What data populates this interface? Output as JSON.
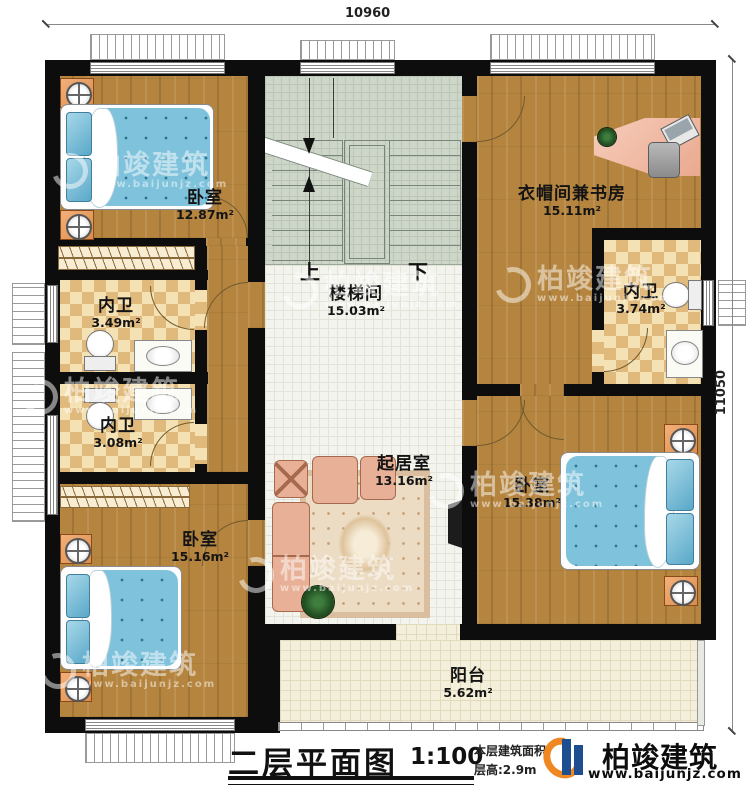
{
  "dimensions": {
    "top": "10960",
    "right": "11050"
  },
  "stairs": {
    "up": "上",
    "down": "下"
  },
  "rooms": [
    {
      "id": "bedroom-top-left",
      "name": "卧室",
      "area": "12.87m²"
    },
    {
      "id": "cloakroom-study",
      "name": "衣帽间兼书房",
      "area": "15.11m²"
    },
    {
      "id": "bath-left-upper",
      "name": "内卫",
      "area": "3.49m²"
    },
    {
      "id": "bath-right",
      "name": "内卫",
      "area": "3.74m²"
    },
    {
      "id": "bath-left-lower",
      "name": "内卫",
      "area": "3.08m²"
    },
    {
      "id": "stair-hall",
      "name": "楼梯间",
      "area": "15.03m²"
    },
    {
      "id": "living",
      "name": "起居室",
      "area": "13.16m²"
    },
    {
      "id": "bedroom-right",
      "name": "卧室",
      "area": "15.38m²"
    },
    {
      "id": "bedroom-bottom-left",
      "name": "卧室",
      "area": "15.16m²"
    },
    {
      "id": "balcony",
      "name": "阳台",
      "area": "5.62m²"
    }
  ],
  "title_block": {
    "title": "二层平面图",
    "scale": "1:100",
    "area_line": "本层建筑面积:",
    "height_line": "层高:2.9m",
    "brand": "柏竣建筑",
    "brand_url": "www.baijunjz.com"
  },
  "watermark": {
    "brand": "柏竣建筑",
    "url": "www.baijunjz.com"
  },
  "colors": {
    "wall": "#0d0d0d",
    "wood": "#b5853f",
    "tile": "#e0b97c",
    "stair": "#cdd6c8",
    "bed": "#7fc2dc",
    "brand_orange": "#ef8722",
    "brand_blue": "#1d4e8f"
  }
}
